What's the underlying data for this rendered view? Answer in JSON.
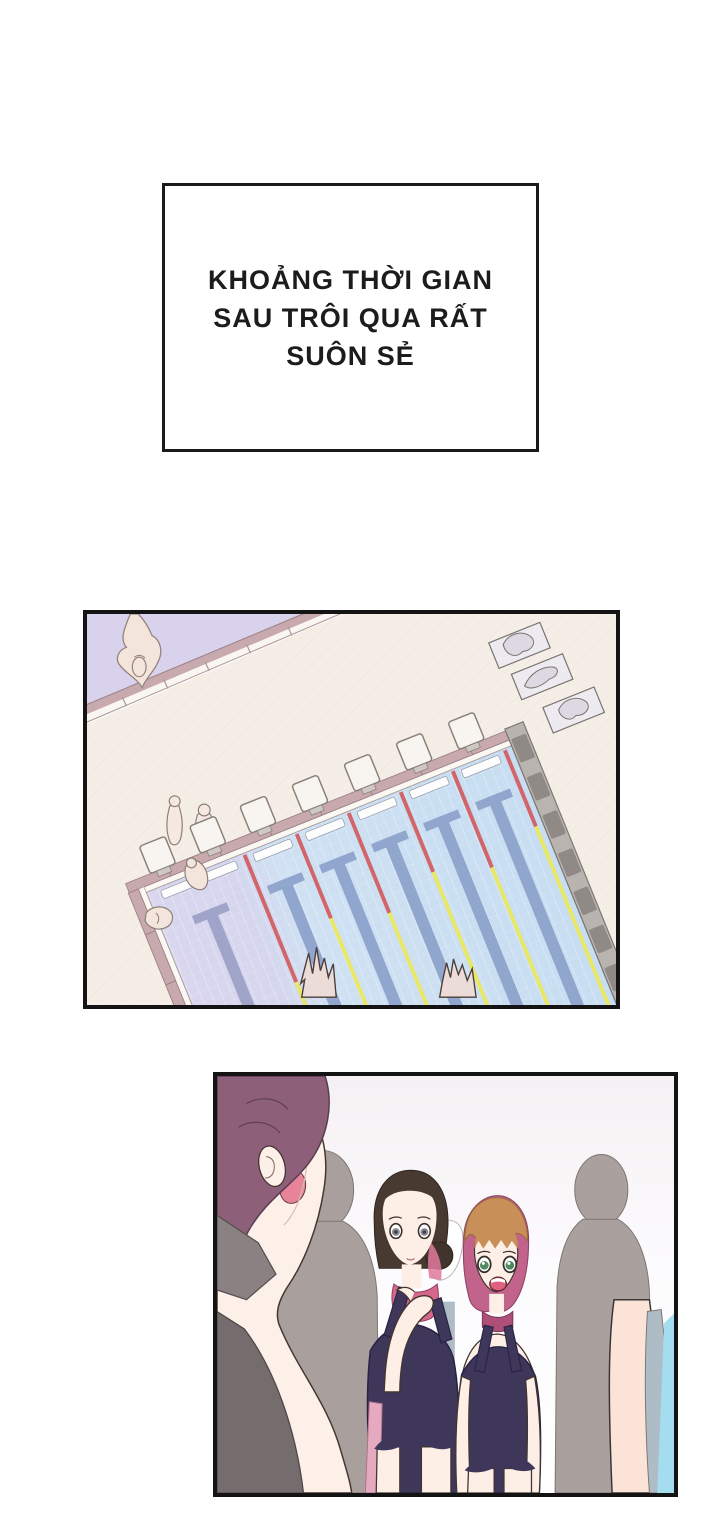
{
  "caption": {
    "lines": [
      "KHOẢNG THỜI GIAN",
      "SAU TRÔI QUA RẤT",
      "SUÔN SẺ"
    ]
  },
  "colors": {
    "ink": "#141414",
    "deck_cream": "#f5eee6",
    "water_blue": "#c9dff2",
    "water_lavender": "#d9d6ee",
    "lane_rope_red": "#d2656a",
    "lane_rope_yellow": "#e9e866",
    "lane_mark_blue": "#8ba0ca",
    "rail_mauve": "#c8a9ae",
    "pool_wall_gray": "#b9b4b0",
    "silhouette_gray": "#a9a09d",
    "skin": "#fdeee6",
    "hair_plum": "#8d5f79",
    "hair_dark_brown": "#483a31",
    "hair_orange": "#c98f59",
    "hair_pink_tint": "#c2638b",
    "swimsuit_navy": "#3e3759",
    "accent_pink": "#d5678c",
    "poolside_cyan": "#a5ddf0"
  }
}
